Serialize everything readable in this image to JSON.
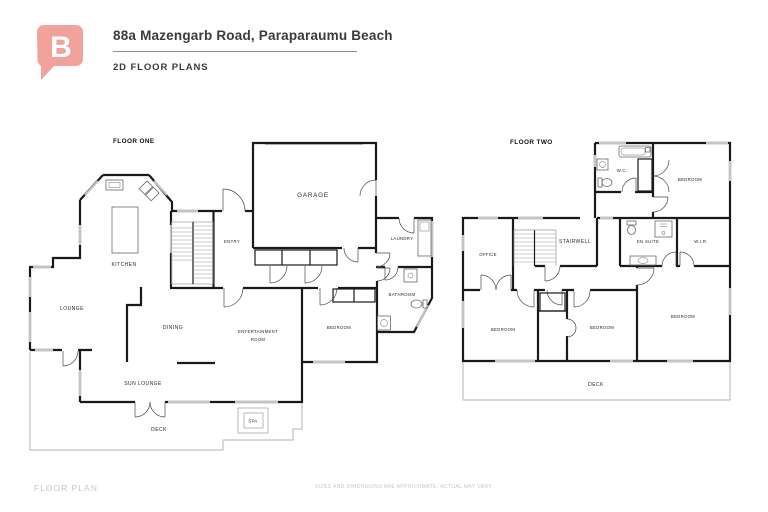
{
  "header": {
    "title": "88a Mazengarb Road, Paraparaumu Beach",
    "subtitle": "2D FLOOR PLANS",
    "logo_letter": "B",
    "logo_color": "#f1a39b"
  },
  "floor_one": {
    "label": "FLOOR ONE",
    "rooms": {
      "kitchen": "KITCHEN",
      "lounge": "LOUNGE",
      "dining": "DINING",
      "sun_lounge": "SUN LOUNGE",
      "deck": "DECK",
      "spa": "SPA",
      "entry": "ENTRY",
      "garage": "GARAGE",
      "laundry": "LAUNDRY",
      "bathroom": "BATHROOM",
      "bedroom": "BEDROOM",
      "entertainment_line1": "ENTERTAINMENT",
      "entertainment_line2": "ROOM"
    }
  },
  "floor_two": {
    "label": "FLOOR TWO",
    "rooms": {
      "wc": "W.C.",
      "bedroom_top": "BEDROOM",
      "office": "OFFICE",
      "stairwell": "STAIRWELL",
      "en_suite": "EN SUITE",
      "wir": "W.I.R.",
      "bedroom_left": "BEDROOM",
      "bedroom_mid": "BEDROOM",
      "bedroom_right": "BEDROOM",
      "deck": "DECK"
    }
  },
  "footer": {
    "label": "FLOOR PLAN",
    "disclaimer": "SIZES AND DIMENSIONS ARE APPROXIMATE, ACTUAL MAY VARY."
  }
}
